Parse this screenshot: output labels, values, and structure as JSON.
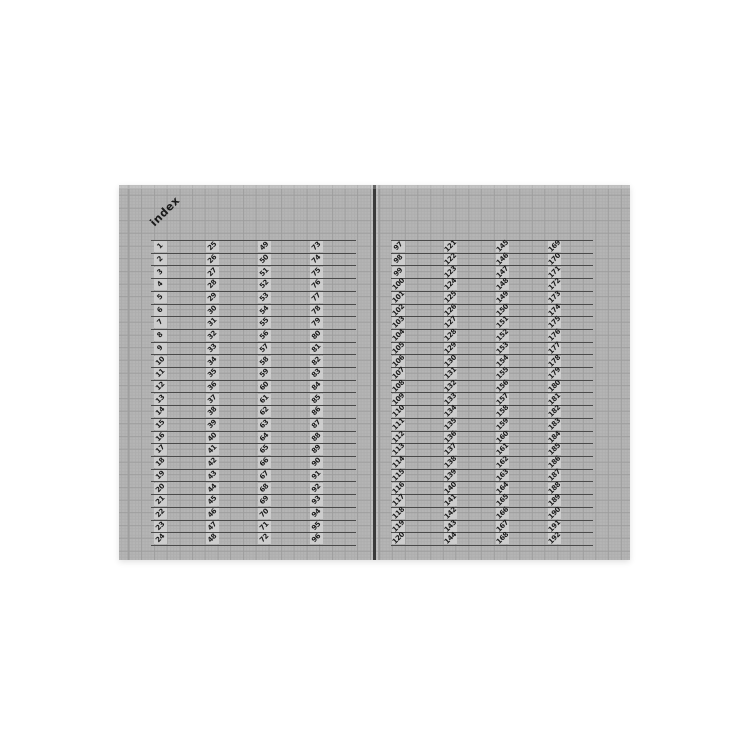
{
  "index_label": "index",
  "colors": {
    "canvas_bg": "#ffffff",
    "page_bg": "#b5b5b5",
    "grid_line": "#9e9e9e",
    "grid_fine": "#aeaeae",
    "row_line": "#4a4a4a",
    "cell_patch": "#cdcdcd",
    "number_text": "#1a1a1a",
    "spine": "#3a3a3a"
  },
  "left_page": {
    "columns": [
      [
        1,
        2,
        3,
        4,
        5,
        6,
        7,
        8,
        9,
        10,
        11,
        12,
        13,
        14,
        15,
        16,
        17,
        18,
        19,
        20,
        21,
        22,
        23,
        24
      ],
      [
        25,
        26,
        27,
        28,
        29,
        30,
        31,
        32,
        33,
        34,
        35,
        36,
        37,
        38,
        39,
        40,
        41,
        42,
        43,
        44,
        45,
        46,
        47,
        48
      ],
      [
        49,
        50,
        51,
        52,
        53,
        54,
        55,
        56,
        57,
        58,
        59,
        60,
        61,
        62,
        63,
        64,
        65,
        66,
        67,
        68,
        69,
        70,
        71,
        72
      ],
      [
        73,
        74,
        75,
        76,
        77,
        78,
        79,
        80,
        81,
        82,
        83,
        84,
        85,
        86,
        87,
        88,
        89,
        90,
        91,
        92,
        93,
        94,
        95,
        96
      ]
    ]
  },
  "right_page": {
    "columns": [
      [
        97,
        98,
        99,
        100,
        101,
        102,
        103,
        104,
        105,
        106,
        107,
        108,
        109,
        110,
        111,
        112,
        113,
        114,
        115,
        116,
        117,
        118,
        119,
        120
      ],
      [
        121,
        122,
        123,
        124,
        125,
        126,
        127,
        128,
        129,
        130,
        131,
        132,
        133,
        134,
        135,
        136,
        137,
        138,
        139,
        140,
        141,
        142,
        143,
        144
      ],
      [
        145,
        146,
        147,
        148,
        149,
        150,
        151,
        152,
        153,
        154,
        155,
        156,
        157,
        158,
        159,
        160,
        161,
        162,
        163,
        164,
        165,
        166,
        167,
        168
      ],
      [
        169,
        170,
        171,
        172,
        173,
        174,
        175,
        176,
        177,
        178,
        179,
        180,
        181,
        182,
        183,
        184,
        185,
        186,
        187,
        188,
        189,
        190,
        191,
        192
      ]
    ]
  }
}
